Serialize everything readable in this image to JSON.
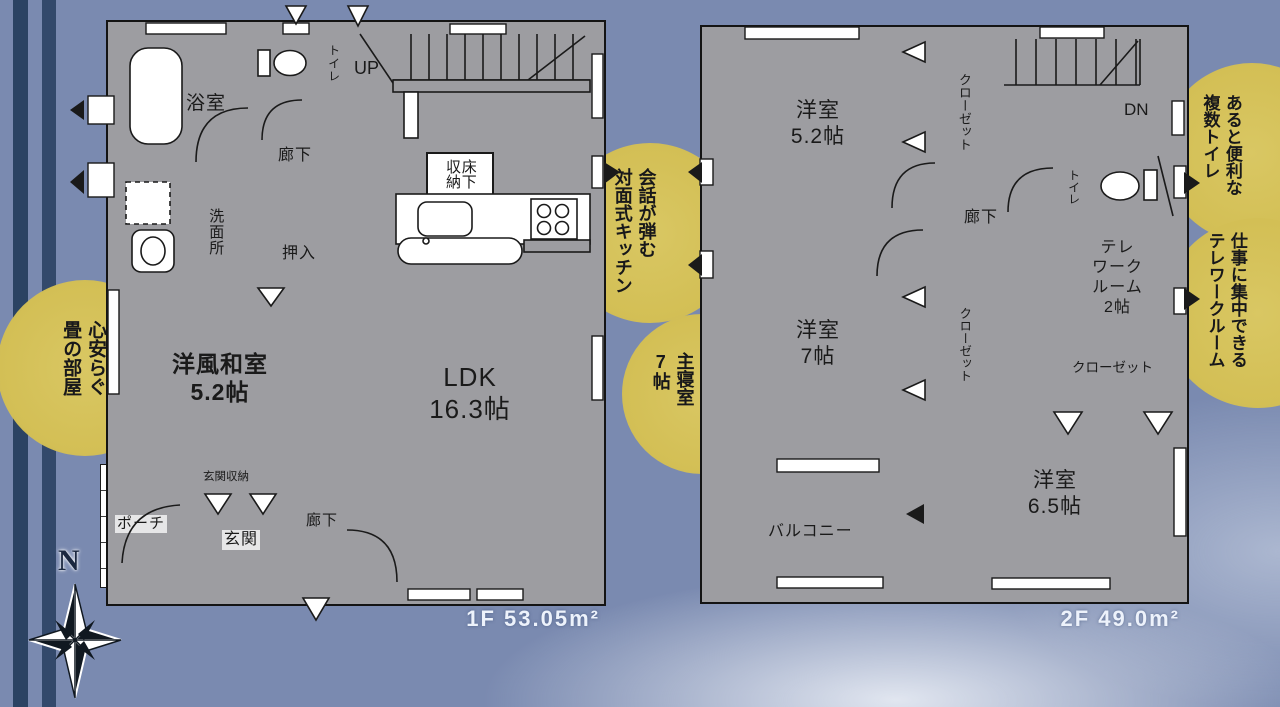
{
  "colors": {
    "bg": "#7a8ab0",
    "stripe1": "#2b4363",
    "stripe2": "#33496b",
    "wall": "#9d9da1",
    "line": "#1a1a1a",
    "room_pink": "#fbe9f2",
    "room_blue": "#cfe3f4",
    "room_yellow": "#f7f3d1",
    "tatami": "#dde4ed",
    "tatami_line": "#98a3b4",
    "circle": "#d3bf55",
    "area_text": "#edf2fb"
  },
  "floor1": {
    "area_label": "1F 53.05m²",
    "labels": {
      "bath": "浴室",
      "toilet": "トイレ",
      "hall_upper": "廊下",
      "washer": "洗",
      "washroom": "洗面所",
      "oshiire": "押入",
      "tatami_name": "洋風和室",
      "tatami_size": "5.2帖",
      "up": "UP",
      "floor_storage": "床下収納",
      "ldk_name": "LDK",
      "ldk_size": "16.3帖",
      "entrance_storage": "玄関収納",
      "porch": "ポーチ",
      "entrance": "玄関",
      "hall_lower": "廊下"
    }
  },
  "floor2": {
    "area_label": "2F 49.0m²",
    "labels": {
      "room52_name": "洋室",
      "room52_size": "5.2帖",
      "closet_top": "クローゼット",
      "dn": "DN",
      "toilet": "トイレ",
      "hall": "廊下",
      "telework_l1": "テレ",
      "telework_l2": "ワーク",
      "telework_l3": "ルーム",
      "telework_l4": "2帖",
      "closet_mid": "クローゼット",
      "room7_name": "洋室",
      "room7_size": "7帖",
      "closet_right": "クローゼット",
      "balcony": "バルコニー",
      "room65_name": "洋室",
      "room65_size": "6.5帖"
    }
  },
  "callouts": {
    "tatami": {
      "first": "心安らぐ",
      "second": "畳の部屋"
    },
    "kitchen": {
      "first": "会話が弾む",
      "second": "対面式キッチン"
    },
    "bedroom": {
      "first": "主寝室",
      "second": "7帖"
    },
    "toilets": {
      "first": "あると便利な",
      "second": "複数トイレ"
    },
    "telework": {
      "first": "仕事に集中できる",
      "second": "テレワークルーム"
    }
  },
  "compass": {
    "north": "N"
  }
}
